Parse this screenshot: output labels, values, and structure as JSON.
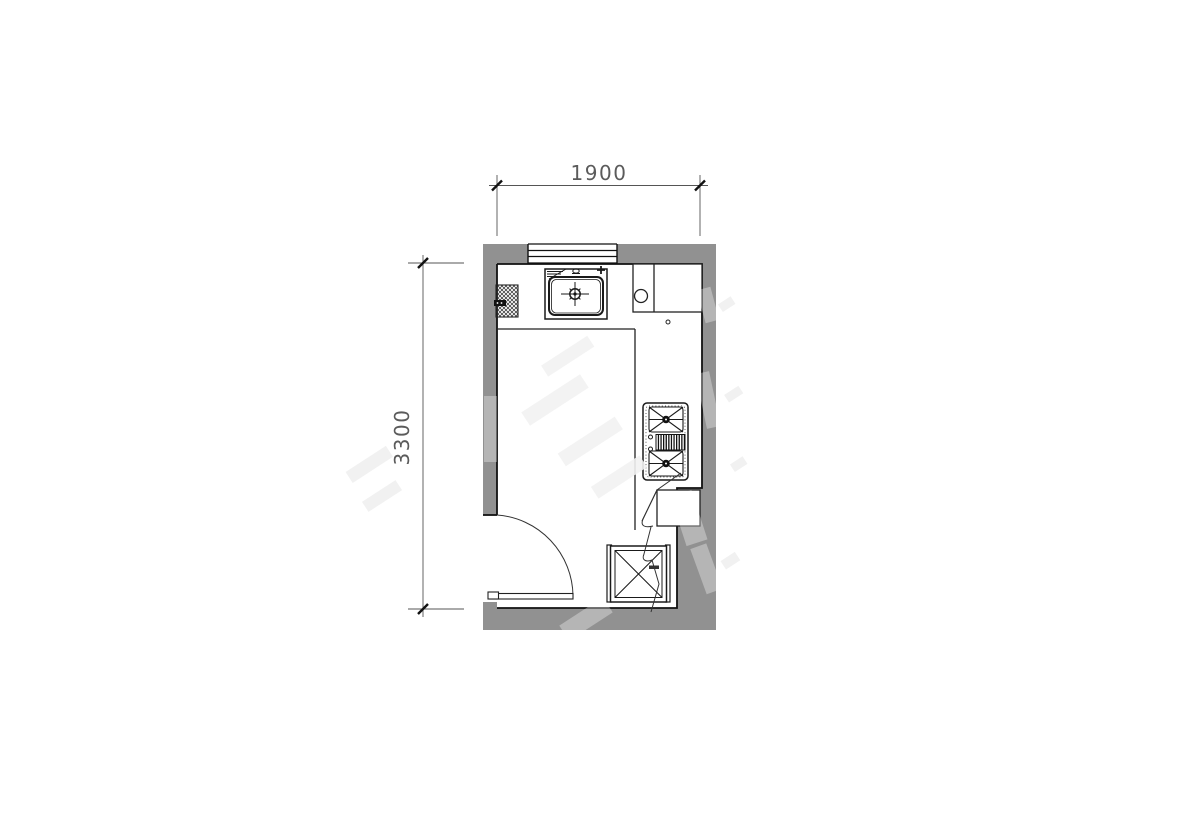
{
  "drawing": {
    "type": "architectural-floor-plan",
    "subject": "kitchen plan with sink, two-burner cooktop, door swing and appliance box",
    "dimensions": {
      "top_width_mm": "1900",
      "left_height_mm": "3300"
    },
    "fixtures": {
      "window": "window in top wall",
      "sink": "kitchen sink with faucet on top counter",
      "pipe_duct": "hatched pipe/duct block on left wall",
      "corner_cabinet": "corner cabinet with round element",
      "cooktop": "two-burner gas cooktop on right counter",
      "appliance_box": "square appliance/shaft box with X diagonals",
      "door": "swing door at bottom-left opening",
      "leader": "leader squiggle annotation near counter end"
    },
    "colors": {
      "background": "#ffffff",
      "wall_fill": "#919191",
      "outline": "#1a1a1a",
      "fixture_line": "#222222",
      "dimension_line": "#555555",
      "dimension_text": "#4a4a4a",
      "watermark": "#e9e9e9"
    }
  }
}
